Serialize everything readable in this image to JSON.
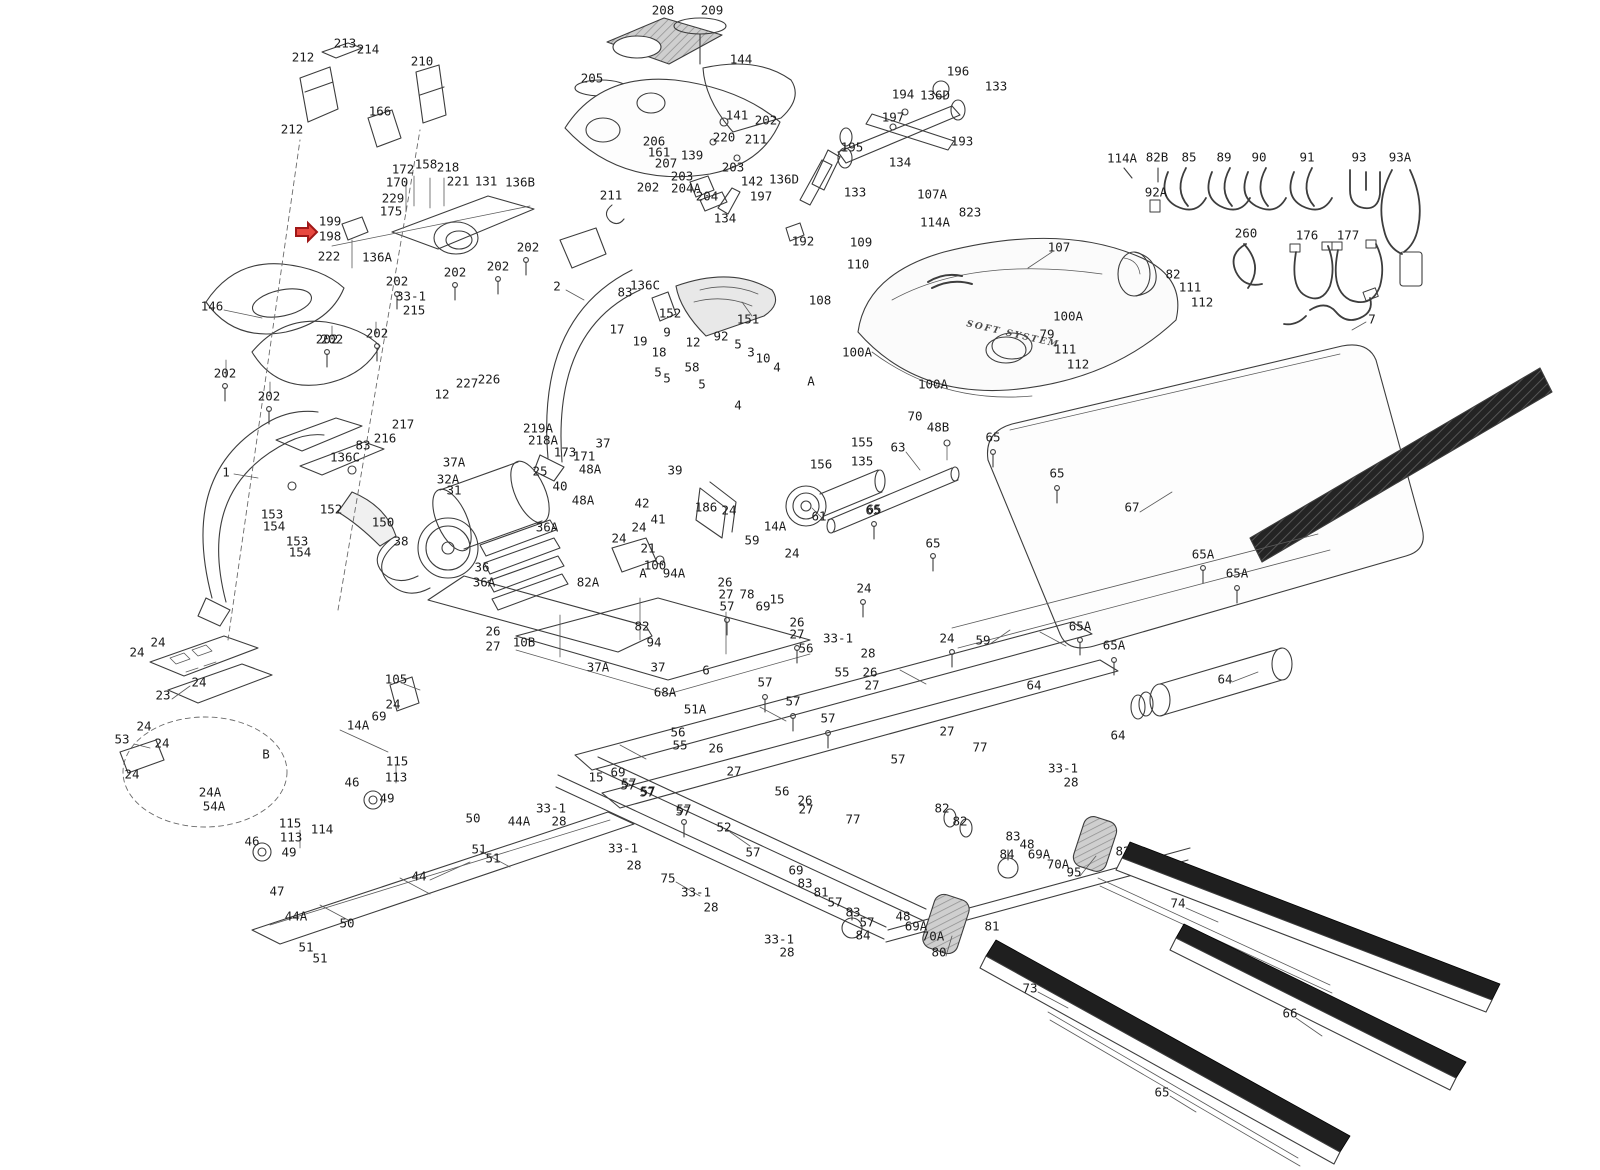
{
  "figure": {
    "description": "Treadmill exploded-view parts diagram with numbered callouts",
    "background": "#ffffff",
    "line_color": "#3d3d3d",
    "label_color": "#1c1c1c",
    "highlight_color": "#e8483f"
  },
  "decorative_text": {
    "hood_tagline": "SOFT SYSTEM"
  },
  "highlight": {
    "part": "198",
    "x": 296,
    "y": 232
  },
  "labels": [
    {
      "t": "213",
      "x": 345,
      "y": 44
    },
    {
      "t": "214",
      "x": 368,
      "y": 50
    },
    {
      "t": "212",
      "x": 303,
      "y": 58
    },
    {
      "t": "212",
      "x": 292,
      "y": 130
    },
    {
      "t": "166",
      "x": 380,
      "y": 112
    },
    {
      "t": "210",
      "x": 422,
      "y": 62
    },
    {
      "t": "208",
      "x": 663,
      "y": 11
    },
    {
      "t": "209",
      "x": 712,
      "y": 11
    },
    {
      "t": "205",
      "x": 592,
      "y": 79
    },
    {
      "t": "144",
      "x": 741,
      "y": 60
    },
    {
      "t": "141",
      "x": 737,
      "y": 116
    },
    {
      "t": "202",
      "x": 766,
      "y": 121
    },
    {
      "t": "220",
      "x": 724,
      "y": 138
    },
    {
      "t": "211",
      "x": 756,
      "y": 140
    },
    {
      "t": "206",
      "x": 654,
      "y": 142
    },
    {
      "t": "161",
      "x": 659,
      "y": 153
    },
    {
      "t": "207",
      "x": 666,
      "y": 164
    },
    {
      "t": "139",
      "x": 692,
      "y": 156
    },
    {
      "t": "203",
      "x": 733,
      "y": 168
    },
    {
      "t": "203",
      "x": 682,
      "y": 177
    },
    {
      "t": "204A",
      "x": 686,
      "y": 189
    },
    {
      "t": "204",
      "x": 707,
      "y": 197
    },
    {
      "t": "142",
      "x": 752,
      "y": 182
    },
    {
      "t": "136D",
      "x": 784,
      "y": 180
    },
    {
      "t": "197",
      "x": 761,
      "y": 197
    },
    {
      "t": "211",
      "x": 611,
      "y": 196
    },
    {
      "t": "202",
      "x": 648,
      "y": 188
    },
    {
      "t": "134",
      "x": 725,
      "y": 219
    },
    {
      "t": "136B",
      "x": 520,
      "y": 183
    },
    {
      "t": "202",
      "x": 528,
      "y": 248
    },
    {
      "t": "172",
      "x": 403,
      "y": 170
    },
    {
      "t": "158",
      "x": 426,
      "y": 165
    },
    {
      "t": "218",
      "x": 448,
      "y": 168
    },
    {
      "t": "170",
      "x": 397,
      "y": 183
    },
    {
      "t": "221",
      "x": 458,
      "y": 182
    },
    {
      "t": "131",
      "x": 486,
      "y": 182
    },
    {
      "t": "229",
      "x": 393,
      "y": 199
    },
    {
      "t": "175",
      "x": 391,
      "y": 212
    },
    {
      "t": "199",
      "x": 330,
      "y": 222
    },
    {
      "t": "198",
      "x": 330,
      "y": 237
    },
    {
      "t": "222",
      "x": 329,
      "y": 257
    },
    {
      "t": "136A",
      "x": 377,
      "y": 258
    },
    {
      "t": "202",
      "x": 498,
      "y": 267
    },
    {
      "t": "202",
      "x": 455,
      "y": 273
    },
    {
      "t": "202",
      "x": 397,
      "y": 282
    },
    {
      "t": "33-1",
      "x": 411,
      "y": 297
    },
    {
      "t": "215",
      "x": 414,
      "y": 311
    },
    {
      "t": "202",
      "x": 377,
      "y": 334
    },
    {
      "t": "202",
      "x": 327,
      "y": 340
    },
    {
      "t": "196",
      "x": 958,
      "y": 72
    },
    {
      "t": "133",
      "x": 996,
      "y": 87
    },
    {
      "t": "194",
      "x": 903,
      "y": 95
    },
    {
      "t": "136D",
      "x": 935,
      "y": 96
    },
    {
      "t": "197",
      "x": 893,
      "y": 118
    },
    {
      "t": "193",
      "x": 962,
      "y": 142
    },
    {
      "t": "134",
      "x": 900,
      "y": 163
    },
    {
      "t": "195",
      "x": 852,
      "y": 148
    },
    {
      "t": "133",
      "x": 855,
      "y": 193
    },
    {
      "t": "107A",
      "x": 932,
      "y": 195
    },
    {
      "t": "823",
      "x": 970,
      "y": 213
    },
    {
      "t": "114A",
      "x": 935,
      "y": 223
    },
    {
      "t": "114A",
      "x": 1122,
      "y": 159
    },
    {
      "t": "82B",
      "x": 1157,
      "y": 158
    },
    {
      "t": "85",
      "x": 1189,
      "y": 158
    },
    {
      "t": "89",
      "x": 1224,
      "y": 158
    },
    {
      "t": "90",
      "x": 1259,
      "y": 158
    },
    {
      "t": "91",
      "x": 1307,
      "y": 158
    },
    {
      "t": "93",
      "x": 1359,
      "y": 158
    },
    {
      "t": "93A",
      "x": 1400,
      "y": 158
    },
    {
      "t": "92A",
      "x": 1156,
      "y": 193
    },
    {
      "t": "260",
      "x": 1246,
      "y": 234
    },
    {
      "t": "176",
      "x": 1307,
      "y": 236
    },
    {
      "t": "177",
      "x": 1348,
      "y": 236
    },
    {
      "t": "7",
      "x": 1372,
      "y": 320
    },
    {
      "t": "192",
      "x": 803,
      "y": 242
    },
    {
      "t": "109",
      "x": 861,
      "y": 243
    },
    {
      "t": "110",
      "x": 858,
      "y": 265
    },
    {
      "t": "108",
      "x": 820,
      "y": 301
    },
    {
      "t": "107",
      "x": 1059,
      "y": 248
    },
    {
      "t": "100A",
      "x": 1068,
      "y": 317
    },
    {
      "t": "79",
      "x": 1047,
      "y": 335
    },
    {
      "t": "111",
      "x": 1065,
      "y": 350
    },
    {
      "t": "112",
      "x": 1078,
      "y": 365
    },
    {
      "t": "100A",
      "x": 857,
      "y": 353
    },
    {
      "t": "100A",
      "x": 933,
      "y": 385
    },
    {
      "t": "A",
      "x": 811,
      "y": 382
    },
    {
      "t": "82",
      "x": 1173,
      "y": 275
    },
    {
      "t": "111",
      "x": 1190,
      "y": 288
    },
    {
      "t": "112",
      "x": 1202,
      "y": 303
    },
    {
      "t": "146",
      "x": 212,
      "y": 307
    },
    {
      "t": "202",
      "x": 225,
      "y": 374
    },
    {
      "t": "202",
      "x": 269,
      "y": 397
    },
    {
      "t": "202",
      "x": 332,
      "y": 340
    },
    {
      "t": "227",
      "x": 467,
      "y": 384
    },
    {
      "t": "226",
      "x": 489,
      "y": 380
    },
    {
      "t": "12",
      "x": 442,
      "y": 395
    },
    {
      "t": "217",
      "x": 403,
      "y": 425
    },
    {
      "t": "216",
      "x": 385,
      "y": 439
    },
    {
      "t": "83",
      "x": 363,
      "y": 446
    },
    {
      "t": "136C",
      "x": 345,
      "y": 458
    },
    {
      "t": "1",
      "x": 226,
      "y": 473
    },
    {
      "t": "153",
      "x": 272,
      "y": 515
    },
    {
      "t": "154",
      "x": 274,
      "y": 527
    },
    {
      "t": "152",
      "x": 331,
      "y": 510
    },
    {
      "t": "153",
      "x": 297,
      "y": 542
    },
    {
      "t": "154",
      "x": 300,
      "y": 553
    },
    {
      "t": "150",
      "x": 383,
      "y": 523
    },
    {
      "t": "38",
      "x": 401,
      "y": 542
    },
    {
      "t": "37A",
      "x": 454,
      "y": 463
    },
    {
      "t": "32A",
      "x": 448,
      "y": 480
    },
    {
      "t": "31",
      "x": 454,
      "y": 491
    },
    {
      "t": "2",
      "x": 557,
      "y": 287
    },
    {
      "t": "136C",
      "x": 645,
      "y": 286
    },
    {
      "t": "83",
      "x": 625,
      "y": 293
    },
    {
      "t": "152",
      "x": 670,
      "y": 314
    },
    {
      "t": "151",
      "x": 748,
      "y": 320
    },
    {
      "t": "17",
      "x": 617,
      "y": 330
    },
    {
      "t": "19",
      "x": 640,
      "y": 342
    },
    {
      "t": "9",
      "x": 667,
      "y": 333
    },
    {
      "t": "18",
      "x": 659,
      "y": 353
    },
    {
      "t": "12",
      "x": 693,
      "y": 343
    },
    {
      "t": "92",
      "x": 721,
      "y": 337
    },
    {
      "t": "5",
      "x": 738,
      "y": 345
    },
    {
      "t": "3",
      "x": 751,
      "y": 353
    },
    {
      "t": "10",
      "x": 763,
      "y": 359
    },
    {
      "t": "4",
      "x": 777,
      "y": 368
    },
    {
      "t": "58",
      "x": 692,
      "y": 368
    },
    {
      "t": "5",
      "x": 658,
      "y": 373
    },
    {
      "t": "5",
      "x": 667,
      "y": 379
    },
    {
      "t": "5",
      "x": 702,
      "y": 385
    },
    {
      "t": "4",
      "x": 738,
      "y": 406
    },
    {
      "t": "155",
      "x": 862,
      "y": 443
    },
    {
      "t": "135",
      "x": 862,
      "y": 462
    },
    {
      "t": "156",
      "x": 821,
      "y": 465
    },
    {
      "t": "219A",
      "x": 538,
      "y": 429
    },
    {
      "t": "218A",
      "x": 543,
      "y": 441
    },
    {
      "t": "173",
      "x": 565,
      "y": 453
    },
    {
      "t": "171",
      "x": 584,
      "y": 457
    },
    {
      "t": "37",
      "x": 603,
      "y": 444
    },
    {
      "t": "48A",
      "x": 590,
      "y": 470
    },
    {
      "t": "39",
      "x": 675,
      "y": 471
    },
    {
      "t": "25",
      "x": 540,
      "y": 472
    },
    {
      "t": "40",
      "x": 560,
      "y": 487
    },
    {
      "t": "48A",
      "x": 583,
      "y": 501
    },
    {
      "t": "42",
      "x": 642,
      "y": 504
    },
    {
      "t": "41",
      "x": 658,
      "y": 520
    },
    {
      "t": "24",
      "x": 639,
      "y": 528
    },
    {
      "t": "24",
      "x": 619,
      "y": 539
    },
    {
      "t": "21",
      "x": 648,
      "y": 549
    },
    {
      "t": "100",
      "x": 655,
      "y": 566
    },
    {
      "t": "94A",
      "x": 674,
      "y": 574
    },
    {
      "t": "36A",
      "x": 547,
      "y": 528
    },
    {
      "t": "36",
      "x": 482,
      "y": 568
    },
    {
      "t": "36A",
      "x": 484,
      "y": 583
    },
    {
      "t": "26",
      "x": 493,
      "y": 632
    },
    {
      "t": "27",
      "x": 493,
      "y": 647
    },
    {
      "t": "10B",
      "x": 524,
      "y": 643
    },
    {
      "t": "82A",
      "x": 588,
      "y": 583
    },
    {
      "t": "186",
      "x": 706,
      "y": 508
    },
    {
      "t": "24",
      "x": 729,
      "y": 511
    },
    {
      "t": "14A",
      "x": 775,
      "y": 527
    },
    {
      "t": "59",
      "x": 752,
      "y": 541
    },
    {
      "t": "24",
      "x": 792,
      "y": 554
    },
    {
      "t": "61",
      "x": 819,
      "y": 517
    },
    {
      "t": "65",
      "x": 874,
      "y": 510
    },
    {
      "t": "63",
      "x": 898,
      "y": 448
    },
    {
      "t": "70",
      "x": 915,
      "y": 417
    },
    {
      "t": "48B",
      "x": 938,
      "y": 428
    },
    {
      "t": "26",
      "x": 725,
      "y": 583
    },
    {
      "t": "27",
      "x": 726,
      "y": 595
    },
    {
      "t": "57",
      "x": 727,
      "y": 607
    },
    {
      "t": "78",
      "x": 747,
      "y": 595
    },
    {
      "t": "15",
      "x": 777,
      "y": 600
    },
    {
      "t": "69",
      "x": 763,
      "y": 607
    },
    {
      "t": "26",
      "x": 797,
      "y": 623
    },
    {
      "t": "27",
      "x": 797,
      "y": 635
    },
    {
      "t": "56",
      "x": 806,
      "y": 649
    },
    {
      "t": "33-1",
      "x": 838,
      "y": 639
    },
    {
      "t": "28",
      "x": 868,
      "y": 654
    },
    {
      "t": "24",
      "x": 864,
      "y": 589
    },
    {
      "t": "55",
      "x": 842,
      "y": 673
    },
    {
      "t": "26",
      "x": 870,
      "y": 673
    },
    {
      "t": "27",
      "x": 872,
      "y": 686
    },
    {
      "t": "57",
      "x": 765,
      "y": 683
    },
    {
      "t": "57",
      "x": 793,
      "y": 702
    },
    {
      "t": "57",
      "x": 828,
      "y": 719
    },
    {
      "t": "51A",
      "x": 695,
      "y": 710
    },
    {
      "t": "68A",
      "x": 665,
      "y": 693
    },
    {
      "t": "56",
      "x": 678,
      "y": 733
    },
    {
      "t": "55",
      "x": 680,
      "y": 746
    },
    {
      "t": "26",
      "x": 716,
      "y": 749
    },
    {
      "t": "27",
      "x": 734,
      "y": 772
    },
    {
      "t": "15",
      "x": 596,
      "y": 778
    },
    {
      "t": "69",
      "x": 618,
      "y": 773
    },
    {
      "t": "57",
      "x": 629,
      "y": 784
    },
    {
      "t": "57",
      "x": 648,
      "y": 792
    },
    {
      "t": "57",
      "x": 684,
      "y": 810
    },
    {
      "t": "56",
      "x": 782,
      "y": 792
    },
    {
      "t": "26",
      "x": 805,
      "y": 801
    },
    {
      "t": "27",
      "x": 806,
      "y": 810
    },
    {
      "t": "6",
      "x": 706,
      "y": 671
    },
    {
      "t": "37",
      "x": 658,
      "y": 668
    },
    {
      "t": "82",
      "x": 642,
      "y": 627
    },
    {
      "t": "94",
      "x": 654,
      "y": 643
    },
    {
      "t": "37A",
      "x": 598,
      "y": 668
    },
    {
      "t": "A",
      "x": 643,
      "y": 574
    },
    {
      "t": "24",
      "x": 158,
      "y": 643
    },
    {
      "t": "24",
      "x": 137,
      "y": 653
    },
    {
      "t": "24",
      "x": 199,
      "y": 683
    },
    {
      "t": "23",
      "x": 163,
      "y": 696
    },
    {
      "t": "24",
      "x": 144,
      "y": 727
    },
    {
      "t": "24",
      "x": 162,
      "y": 744
    },
    {
      "t": "53",
      "x": 122,
      "y": 740
    },
    {
      "t": "24",
      "x": 132,
      "y": 775
    },
    {
      "t": "24A",
      "x": 210,
      "y": 793
    },
    {
      "t": "54A",
      "x": 214,
      "y": 807
    },
    {
      "t": "B",
      "x": 266,
      "y": 755
    },
    {
      "t": "105",
      "x": 396,
      "y": 680
    },
    {
      "t": "24",
      "x": 393,
      "y": 705
    },
    {
      "t": "69",
      "x": 379,
      "y": 717
    },
    {
      "t": "14A",
      "x": 358,
      "y": 726
    },
    {
      "t": "115",
      "x": 397,
      "y": 762
    },
    {
      "t": "113",
      "x": 396,
      "y": 778
    },
    {
      "t": "46",
      "x": 352,
      "y": 783
    },
    {
      "t": "49",
      "x": 387,
      "y": 799
    },
    {
      "t": "115",
      "x": 290,
      "y": 824
    },
    {
      "t": "114",
      "x": 322,
      "y": 830
    },
    {
      "t": "113",
      "x": 291,
      "y": 838
    },
    {
      "t": "49",
      "x": 289,
      "y": 853
    },
    {
      "t": "46",
      "x": 252,
      "y": 842
    },
    {
      "t": "47",
      "x": 277,
      "y": 892
    },
    {
      "t": "44A",
      "x": 296,
      "y": 917
    },
    {
      "t": "50",
      "x": 347,
      "y": 924
    },
    {
      "t": "51",
      "x": 306,
      "y": 948
    },
    {
      "t": "51",
      "x": 320,
      "y": 959
    },
    {
      "t": "44",
      "x": 419,
      "y": 877
    },
    {
      "t": "50",
      "x": 473,
      "y": 819
    },
    {
      "t": "44A",
      "x": 519,
      "y": 822
    },
    {
      "t": "51",
      "x": 479,
      "y": 850
    },
    {
      "t": "51",
      "x": 493,
      "y": 859
    },
    {
      "t": "33-1",
      "x": 551,
      "y": 809
    },
    {
      "t": "28",
      "x": 559,
      "y": 822
    },
    {
      "t": "57",
      "x": 628,
      "y": 786
    },
    {
      "t": "57",
      "x": 647,
      "y": 793
    },
    {
      "t": "57",
      "x": 683,
      "y": 812
    },
    {
      "t": "77",
      "x": 853,
      "y": 820
    },
    {
      "t": "52",
      "x": 724,
      "y": 828
    },
    {
      "t": "57",
      "x": 753,
      "y": 853
    },
    {
      "t": "33-1",
      "x": 623,
      "y": 849
    },
    {
      "t": "28",
      "x": 634,
      "y": 866
    },
    {
      "t": "75",
      "x": 668,
      "y": 879
    },
    {
      "t": "33-1",
      "x": 696,
      "y": 893
    },
    {
      "t": "28",
      "x": 711,
      "y": 908
    },
    {
      "t": "69",
      "x": 796,
      "y": 871
    },
    {
      "t": "83",
      "x": 805,
      "y": 884
    },
    {
      "t": "81",
      "x": 821,
      "y": 893
    },
    {
      "t": "57",
      "x": 835,
      "y": 903
    },
    {
      "t": "83",
      "x": 853,
      "y": 913
    },
    {
      "t": "57",
      "x": 867,
      "y": 923
    },
    {
      "t": "84",
      "x": 863,
      "y": 936
    },
    {
      "t": "33-1",
      "x": 779,
      "y": 940
    },
    {
      "t": "28",
      "x": 787,
      "y": 953
    },
    {
      "t": "27",
      "x": 947,
      "y": 732
    },
    {
      "t": "57",
      "x": 898,
      "y": 760
    },
    {
      "t": "77",
      "x": 980,
      "y": 748
    },
    {
      "t": "33-1",
      "x": 1063,
      "y": 769
    },
    {
      "t": "28",
      "x": 1071,
      "y": 783
    },
    {
      "t": "64",
      "x": 1118,
      "y": 736
    },
    {
      "t": "82",
      "x": 942,
      "y": 809
    },
    {
      "t": "82",
      "x": 960,
      "y": 822
    },
    {
      "t": "83",
      "x": 1013,
      "y": 837
    },
    {
      "t": "84",
      "x": 1007,
      "y": 855
    },
    {
      "t": "48",
      "x": 1027,
      "y": 845
    },
    {
      "t": "69A",
      "x": 1039,
      "y": 855
    },
    {
      "t": "70A",
      "x": 1058,
      "y": 865
    },
    {
      "t": "95",
      "x": 1074,
      "y": 873
    },
    {
      "t": "82",
      "x": 1123,
      "y": 852
    },
    {
      "t": "48",
      "x": 903,
      "y": 917
    },
    {
      "t": "69A",
      "x": 916,
      "y": 927
    },
    {
      "t": "70A",
      "x": 933,
      "y": 937
    },
    {
      "t": "80",
      "x": 939,
      "y": 953
    },
    {
      "t": "81",
      "x": 992,
      "y": 927
    },
    {
      "t": "74",
      "x": 1178,
      "y": 904
    },
    {
      "t": "73",
      "x": 1030,
      "y": 989
    },
    {
      "t": "65",
      "x": 993,
      "y": 438
    },
    {
      "t": "65",
      "x": 1057,
      "y": 474
    },
    {
      "t": "67",
      "x": 1132,
      "y": 508
    },
    {
      "t": "65A",
      "x": 1203,
      "y": 555
    },
    {
      "t": "65A",
      "x": 1237,
      "y": 574
    },
    {
      "t": "65A",
      "x": 1080,
      "y": 627
    },
    {
      "t": "65A",
      "x": 1114,
      "y": 646
    },
    {
      "t": "59",
      "x": 983,
      "y": 641
    },
    {
      "t": "24",
      "x": 947,
      "y": 639
    },
    {
      "t": "64",
      "x": 1225,
      "y": 680
    },
    {
      "t": "64",
      "x": 1034,
      "y": 686
    },
    {
      "t": "65",
      "x": 873,
      "y": 511
    },
    {
      "t": "65",
      "x": 933,
      "y": 544
    },
    {
      "t": "66",
      "x": 1290,
      "y": 1014
    },
    {
      "t": "65",
      "x": 1162,
      "y": 1093
    }
  ]
}
